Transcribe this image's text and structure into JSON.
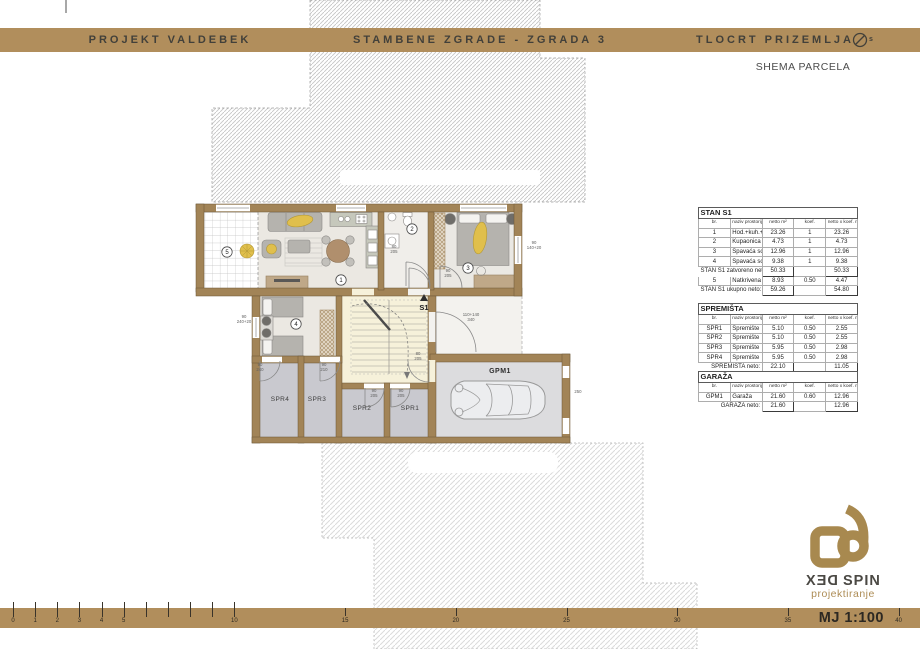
{
  "header": {
    "left_title": "PROJEKT VALDEBEK",
    "center_title": "STAMBENE ZGRADE - ZGRADA 3",
    "right_title": "TLOCRT PRIZEMLJA",
    "compass_letter": "s"
  },
  "subtitle": "SHEMA PARCELA",
  "colors": {
    "band": "#b18e5c",
    "wall": "#a28457",
    "wall_edge": "#6b5637",
    "room_floor": "#ebe8e2",
    "stair_floor": "#f6f1da",
    "storage_floor": "#c9c9cf",
    "garage_floor": "#dcdcde",
    "accent_yellow": "#e0bf4c",
    "furniture_gray": "#b5b3ae",
    "logo_gold": "#a8894f"
  },
  "plan": {
    "unit_label": "S1",
    "garage_label": "GPM1",
    "storage_labels": [
      "SPR4",
      "SPR3",
      "SPR2",
      "SPR1"
    ],
    "rooms": [
      {
        "n": "1",
        "x": 341,
        "y": 280
      },
      {
        "n": "2",
        "x": 412,
        "y": 229
      },
      {
        "n": "3",
        "x": 468,
        "y": 268
      },
      {
        "n": "4",
        "x": 296,
        "y": 324
      },
      {
        "n": "5",
        "x": 227,
        "y": 252
      }
    ],
    "dims": [
      {
        "x": 244,
        "y": 318,
        "l1": "90",
        "l2": "240+20"
      },
      {
        "x": 534,
        "y": 244,
        "l1": "90",
        "l2": "140+20"
      },
      {
        "x": 471,
        "y": 316,
        "l1": "110+140",
        "l2": "340"
      },
      {
        "x": 260,
        "y": 366,
        "l1": "90",
        "l2": "240"
      },
      {
        "x": 324,
        "y": 366,
        "l1": "90",
        "l2": "210"
      },
      {
        "x": 374,
        "y": 392,
        "l1": "90",
        "l2": "205"
      },
      {
        "x": 401,
        "y": 392,
        "l1": "90",
        "l2": "205"
      },
      {
        "x": 418,
        "y": 355,
        "l1": "80",
        "l2": "205"
      },
      {
        "x": 578,
        "y": 393,
        "l1": "250",
        "l2": ""
      },
      {
        "x": 394,
        "y": 248,
        "l1": "80",
        "l2": "205"
      },
      {
        "x": 448,
        "y": 272,
        "l1": "90",
        "l2": "205"
      }
    ]
  },
  "tables": {
    "stan": {
      "title": "STAN S1",
      "headers": [
        "br.",
        "naziv prostorije",
        "netto m²",
        "koef.",
        "netto x koef. m²"
      ],
      "rows": [
        {
          "c": [
            "1",
            "Hod.+kuh.+db+blag.",
            "23.26",
            "1",
            "23.26"
          ]
        },
        {
          "c": [
            "2",
            "Kupaonica",
            "4.73",
            "1",
            "4.73"
          ]
        },
        {
          "c": [
            "3",
            "Spavaća soba",
            "12.96",
            "1",
            "12.96"
          ]
        },
        {
          "c": [
            "4",
            "Spavaća soba",
            "9.38",
            "1",
            "9.38"
          ]
        },
        {
          "label": "STAN S1 zatvoreno neto:",
          "v1": "50.33",
          "k": "",
          "v2": "50.33"
        },
        {
          "c": [
            "5",
            "Natkrivena terasa",
            "8.93",
            "0.50",
            "4.47"
          ]
        },
        {
          "label": "STAN S1 ukupno neto:",
          "v1": "59.26",
          "k": "",
          "v2": "54.80"
        }
      ]
    },
    "spremista": {
      "title": "SPREMIŠTA",
      "headers": [
        "br.",
        "naziv prostorije",
        "netto m²",
        "koef.",
        "netto x koef. m²"
      ],
      "rows": [
        {
          "c": [
            "SPR1",
            "Spremište",
            "5.10",
            "0.50",
            "2.55"
          ]
        },
        {
          "c": [
            "SPR2",
            "Spremište",
            "5.10",
            "0.50",
            "2.55"
          ]
        },
        {
          "c": [
            "SPR3",
            "Spremište",
            "5.95",
            "0.50",
            "2.98"
          ]
        },
        {
          "c": [
            "SPR4",
            "Spremište",
            "5.95",
            "0.50",
            "2.98"
          ]
        },
        {
          "label": "SPREMIŠTA neto:",
          "v1": "22.10",
          "k": "",
          "v2": "11.05"
        }
      ]
    },
    "garaza": {
      "title": "GARAŽA",
      "headers": [
        "br.",
        "naziv prostorije",
        "netto m²",
        "koef.",
        "netto x koef. m²"
      ],
      "rows": [
        {
          "c": [
            "GPM1",
            "Garaža",
            "21.60",
            "0.60",
            "12.96"
          ]
        },
        {
          "label": "GARAŽA neto:",
          "v1": "21.60",
          "k": "",
          "v2": "12.96"
        }
      ]
    }
  },
  "scalebar": {
    "ticks": [
      0,
      1,
      2,
      3,
      4,
      5,
      6,
      7,
      8,
      9,
      10,
      15,
      20,
      25,
      30,
      35,
      40
    ],
    "labeled": [
      "0",
      "1",
      "2",
      "3",
      "4",
      "5",
      "10",
      "15",
      "20",
      "25",
      "30",
      "35",
      "40"
    ],
    "scale_label": "MJ 1:100"
  },
  "logo": {
    "brand_mirrored": "DEX",
    "brand_plain": "SPIN",
    "subtitle": "projektiranje"
  }
}
